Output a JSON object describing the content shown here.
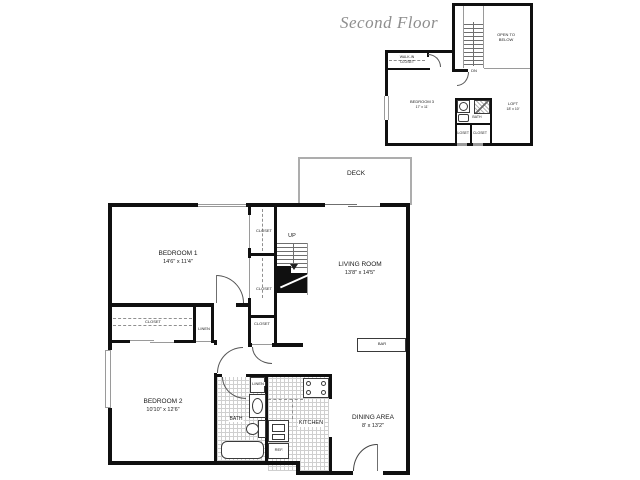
{
  "palette": {
    "wall": "#101010",
    "thin_line": "#9a9a9a",
    "title_gray": "#8e8e8e",
    "tile_gray": "#cfcfcf",
    "text": "#1a1a1a"
  },
  "second_floor": {
    "title": "Second Floor",
    "labels": {
      "open_to_below_line1": "OPEN TO",
      "open_to_below_line2": "BELOW",
      "down": "DN",
      "walk_in_closet_line1": "WALK-IN",
      "walk_in_closet_line2": "CLOSET",
      "bedroom3_name": "BEDROOM 3",
      "bedroom3_dims": "17' x 11'",
      "loft_name": "LOFT",
      "loft_dims": "18' x 10'",
      "bath": "BATH",
      "closet_left": "CLOSET",
      "closet_right": "CLOSET"
    }
  },
  "main_floor": {
    "labels": {
      "deck": "DECK",
      "up": "UP",
      "bedroom1_name": "BEDROOM 1",
      "bedroom1_dims": "14'6\" x 11'4\"",
      "living_name": "LIVING ROOM",
      "living_dims": "13'8\" x 14'5\"",
      "closet_upper": "CLOSET",
      "closet_lower": "CLOSET",
      "closet_west": "CLOSET",
      "linen_hall": "LINEN",
      "closet_hall": "CLOSET",
      "bar": "BAR",
      "bedroom2_name": "BEDROOM 2",
      "bedroom2_dims": "10'10\" x 12'6\"",
      "bath": "BATH",
      "linen_bath": "LINEN",
      "kitchen": "KITCHEN",
      "ref": "REF.",
      "dining_name": "DINING AREA",
      "dining_dims": "8' x 13'2\""
    }
  }
}
